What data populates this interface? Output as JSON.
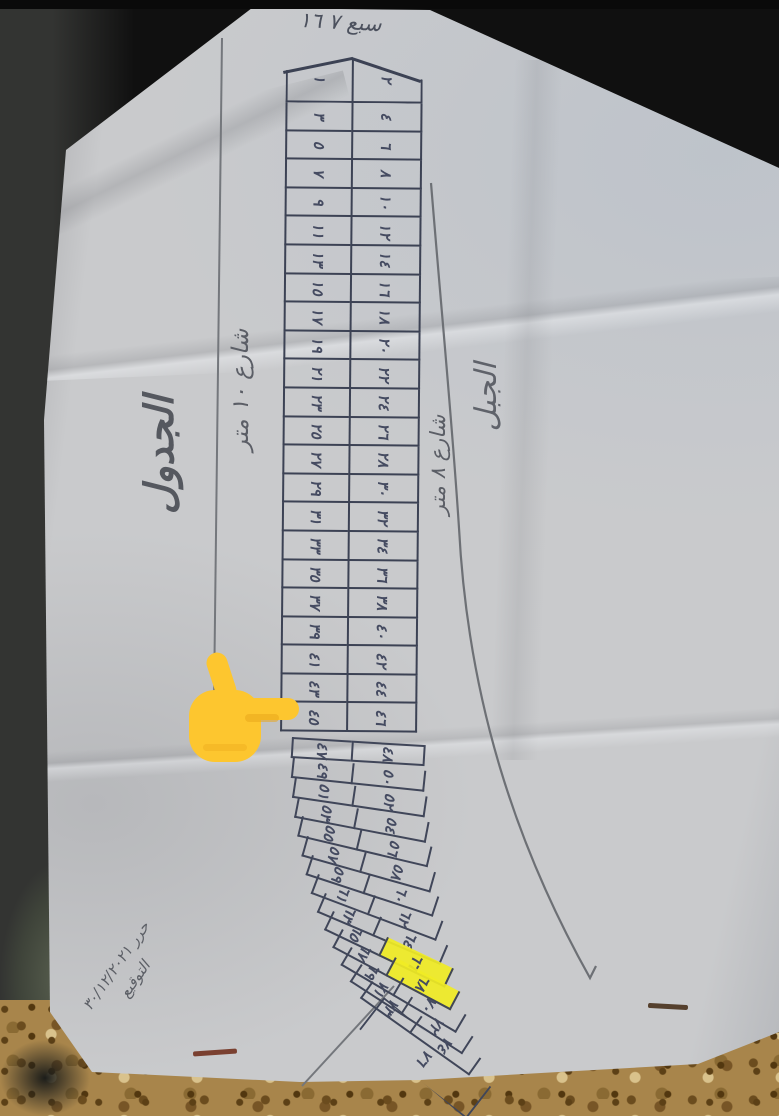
{
  "annotations": {
    "title": "الجدول",
    "street_10m": "شارع ١٠ متر",
    "street_8m": "شارع ٨ متر",
    "area_right": "الجبل",
    "top_note": "سبع ٧ ١٦",
    "bottom_note_line1": "حرر ٣٠/١٢/٢٠٢١",
    "bottom_note_line2": "التوقيع"
  },
  "upper_table": {
    "rows": [
      [
        "١",
        "٢"
      ],
      [
        "٣",
        "٤"
      ],
      [
        "٥",
        "٦"
      ],
      [
        "٧",
        "٨"
      ],
      [
        "٩",
        "١٠"
      ],
      [
        "١١",
        "١٢"
      ],
      [
        "١٣",
        "١٤"
      ],
      [
        "١٥",
        "١٦"
      ],
      [
        "١٧",
        "١٨"
      ],
      [
        "١٩",
        "٢٠"
      ],
      [
        "٢١",
        "٢٢"
      ],
      [
        "٢٣",
        "٢٤"
      ],
      [
        "٢٥",
        "٢٦"
      ],
      [
        "٢٧",
        "٢٨"
      ],
      [
        "٢٩",
        "٣٠"
      ],
      [
        "٣١",
        "٣٢"
      ],
      [
        "٣٣",
        "٣٤"
      ],
      [
        "٣٥",
        "٣٦"
      ],
      [
        "٣٧",
        "٣٨"
      ],
      [
        "٣٩",
        "٤٠"
      ],
      [
        "٤١",
        "٤٢"
      ],
      [
        "٤٣",
        "٤٤"
      ],
      [
        "٤٥",
        "٤٦"
      ]
    ]
  },
  "lower_table": {
    "rows": [
      [
        "٤٧",
        "٤٨"
      ],
      [
        "٤٩",
        "٥٠"
      ],
      [
        "٥١",
        "٥٢"
      ],
      [
        "٥٣",
        "٥٤"
      ],
      [
        "٥٥",
        "٥٦"
      ],
      [
        "٥٧",
        "٥٨"
      ],
      [
        "٥٩",
        "٦٠"
      ],
      [
        "٦١",
        "٦٢"
      ],
      [
        "٦٣",
        "٦٤"
      ],
      [
        "٦٥",
        "٦٦"
      ],
      [
        "٦٧",
        "٦٨"
      ],
      [
        "٦٩",
        "٧٠"
      ],
      [
        "٧١",
        "٧٢"
      ],
      [
        "٧٣",
        "٧٤"
      ]
    ],
    "highlight_right_rows": [
      9,
      10
    ],
    "highlighted_values": [
      "٦٦",
      "٦٨"
    ],
    "tail_label": "٧٦"
  },
  "colors": {
    "ink": "#3c4254",
    "pencil": "#6d7075",
    "highlight": "#f0eb24",
    "pointer_hand": "#fdc62f",
    "paper": "#c9cacc",
    "fabric": "#a8854b"
  }
}
